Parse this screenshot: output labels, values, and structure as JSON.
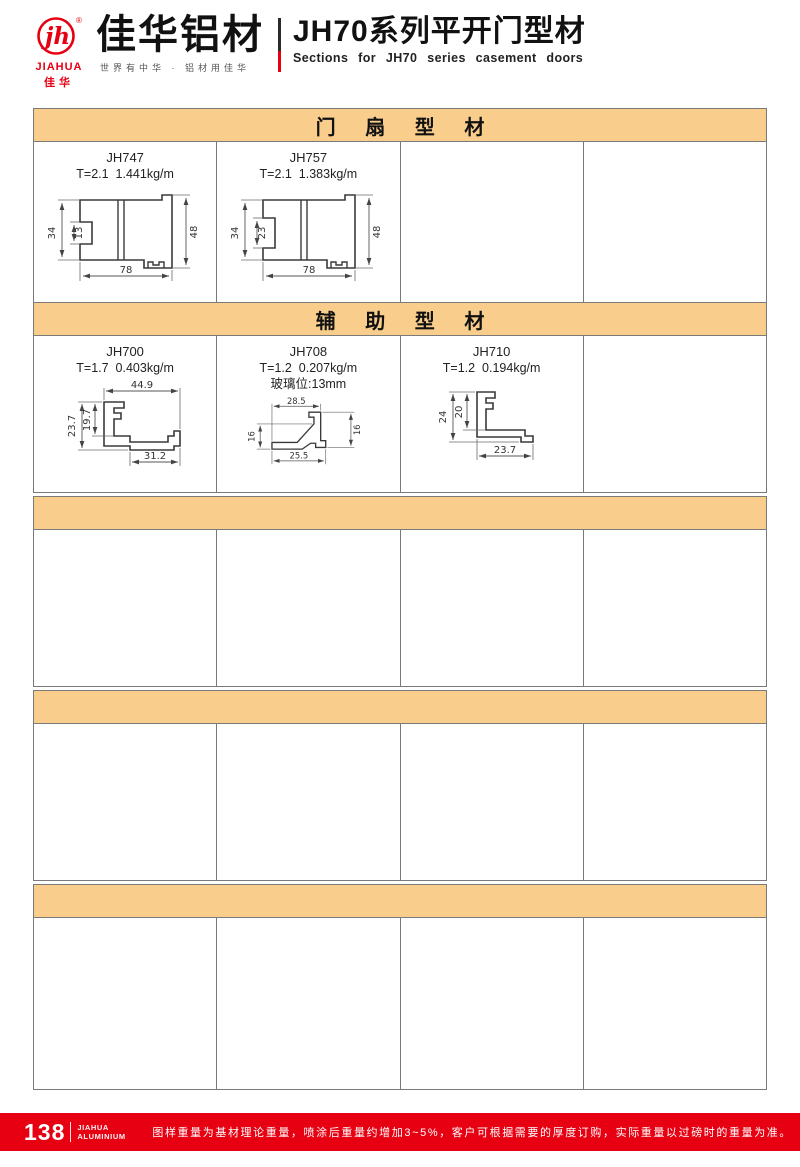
{
  "header": {
    "logo": {
      "monogram": "jh",
      "registered": "®",
      "brand_en": "JIAHUA",
      "brand_cn": "佳华"
    },
    "company_name": "佳华铝材",
    "tagline": "世界有中华 · 铝材用佳华",
    "series_title_cn": "JH70系列平开门型材",
    "series_title_en": "Sections for JH70 series casement doors"
  },
  "sections": {
    "door_sash_title": "门 扇 型 材",
    "auxiliary_title": "辅 助 型 材"
  },
  "profiles": {
    "jh747": {
      "code": "JH747",
      "spec": "T=2.1  1.441kg/m",
      "dims": {
        "left": "34",
        "notch": "13",
        "right": "48",
        "bottom": "78"
      }
    },
    "jh757": {
      "code": "JH757",
      "spec": "T=2.1  1.383kg/m",
      "dims": {
        "left": "34",
        "notch": "23",
        "right": "48",
        "bottom": "78"
      }
    },
    "jh700": {
      "code": "JH700",
      "spec": "T=1.7  0.403kg/m",
      "dims": {
        "top": "44.9",
        "left": "23.7",
        "inner": "19.7",
        "bottom": "31.2"
      }
    },
    "jh708": {
      "code": "JH708",
      "spec": "T=1.2  0.207kg/m",
      "note": "玻璃位:13mm",
      "dims": {
        "top": "28.5",
        "left": "16",
        "right": "16",
        "bottom": "25.5"
      }
    },
    "jh710": {
      "code": "JH710",
      "spec": "T=1.2  0.194kg/m",
      "dims": {
        "left": "24",
        "inner": "20",
        "bottom": "23.7"
      }
    }
  },
  "footer": {
    "page_number": "138",
    "brand_line1": "JIAHUA",
    "brand_line2": "ALUMINIUM",
    "note": "图样重量为基材理论重量，喷涂后重量约增加3~5%，客户可根据需要的厚度订购，实际重量以过磅时的重量为准。"
  },
  "colors": {
    "accent_red": "#E60012",
    "section_bar": "#F9CE8C",
    "table_border": "#7a7a7a"
  }
}
